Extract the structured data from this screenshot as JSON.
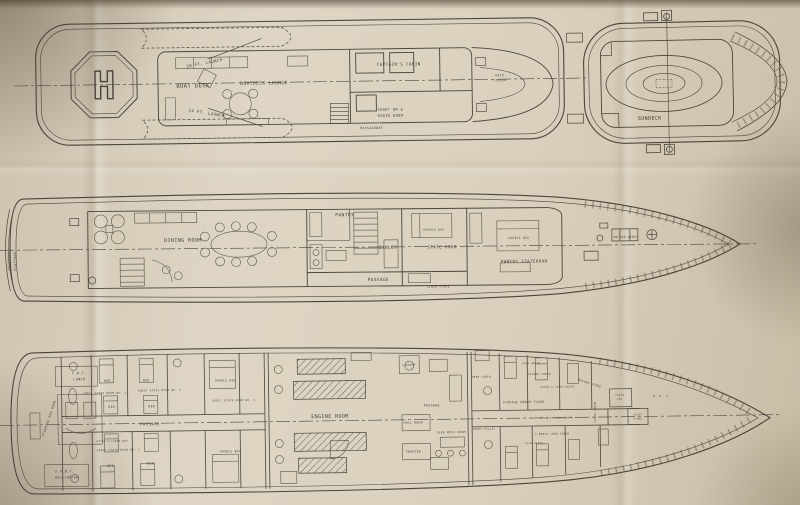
{
  "drawing": {
    "type": "yacht-general-arrangement-plan",
    "paper_color": "#dad0bd",
    "ink_color": "#4a453c"
  },
  "decks": [
    {
      "name": "BOAT DECK",
      "labels": [
        {
          "t": "20 FT. LAUNCH",
          "x": 205,
          "y": 63,
          "s": 4,
          "r": -10
        },
        {
          "t": "BOAT DECK",
          "x": 193,
          "y": 86,
          "s": 5.5,
          "sp": 2.5
        },
        {
          "t": "24 FT. LAUNCH",
          "x": 206,
          "y": 113,
          "s": 4,
          "r": 10
        },
        {
          "t": "BOATDECK LOUNGE",
          "x": 264,
          "y": 84,
          "s": 4.6,
          "sp": 0.6
        },
        {
          "t": "CAPTAIN'S CABIN",
          "x": 399,
          "y": 67,
          "s": 4.2
        },
        {
          "t": "CHART RM &",
          "x": 390,
          "y": 112,
          "s": 3.6
        },
        {
          "t": "RADIO ROOM",
          "x": 390,
          "y": 118,
          "s": 3.6
        },
        {
          "t": "PASSAGEWAY",
          "x": 371,
          "y": 130,
          "s": 3.2
        },
        {
          "t": "DECK",
          "x": 500,
          "y": 79,
          "s": 3
        },
        {
          "t": "LOCKER",
          "x": 500,
          "y": 84,
          "s": 3
        },
        {
          "t": "H",
          "x": 104,
          "y": 96,
          "s": 38,
          "cls": "heli"
        }
      ]
    },
    {
      "name": "SUNDECK",
      "labels": [
        {
          "t": "SUNDECK",
          "x": 649,
          "y": 119,
          "s": 5,
          "sp": 2
        }
      ]
    },
    {
      "name": "MAIN DECK",
      "labels": [
        {
          "t": "SWIMMING",
          "x": 10,
          "y": 258,
          "s": 3.2,
          "r": -90
        },
        {
          "t": "PLATFORM",
          "x": 16,
          "y": 258,
          "s": 3.2,
          "r": -90
        },
        {
          "t": "DINING ROOM",
          "x": 183,
          "y": 240,
          "s": 5,
          "sp": 1.2
        },
        {
          "t": "PANTRY",
          "x": 345,
          "y": 216,
          "s": 4.6,
          "sp": 0.8
        },
        {
          "t": "GALLEY",
          "x": 388,
          "y": 249,
          "s": 4.6,
          "sp": 0.8
        },
        {
          "t": "PASSAGE",
          "x": 378,
          "y": 281,
          "s": 4.4,
          "sp": 1
        },
        {
          "t": "STATE ROOM",
          "x": 442,
          "y": 249,
          "s": 4.2
        },
        {
          "t": "DOUBLE BED",
          "x": 434,
          "y": 231,
          "s": 2.8
        },
        {
          "t": "LINEN STORE",
          "x": 438,
          "y": 288,
          "s": 2.8
        },
        {
          "t": "OWNERS STATEROOM",
          "x": 524,
          "y": 264,
          "s": 4.2
        },
        {
          "t": "DOUBLE BED",
          "x": 519,
          "y": 240,
          "s": 2.8
        },
        {
          "t": "ANCHOR WINCH",
          "x": 626,
          "y": 240,
          "s": 2.8
        }
      ]
    },
    {
      "name": "LOWER DECK",
      "labels": [
        {
          "t": "F.B.T.",
          "x": 80,
          "y": 370,
          "s": 3.4
        },
        {
          "t": "LUNCH",
          "x": 80,
          "y": 376,
          "s": 3.4
        },
        {
          "t": "STEERING ENG ROOM",
          "x": 50,
          "y": 414,
          "s": 3,
          "r": -70
        },
        {
          "t": "F.P.B.T.",
          "x": 64,
          "y": 468,
          "s": 3.2
        },
        {
          "t": "HELICOPTER",
          "x": 66,
          "y": 474,
          "s": 3.2
        },
        {
          "t": "BED",
          "x": 108,
          "y": 378,
          "s": 3
        },
        {
          "t": "BED",
          "x": 147,
          "y": 378,
          "s": 3
        },
        {
          "t": "GUEST STATE ROOM NO. 1",
          "x": 105,
          "y": 390,
          "s": 2.6
        },
        {
          "t": "GUEST STATE ROOM NO. 2",
          "x": 160,
          "y": 388,
          "s": 2.6
        },
        {
          "t": "BED",
          "x": 112,
          "y": 404,
          "s": 3
        },
        {
          "t": "BED",
          "x": 152,
          "y": 404,
          "s": 3
        },
        {
          "t": "PASSAGE",
          "x": 150,
          "y": 422,
          "s": 4,
          "sp": 1
        },
        {
          "t": "UPPER & LOWER BED",
          "x": 112,
          "y": 438,
          "s": 2.4
        },
        {
          "t": "GUEST STATE ROOM NO. 3",
          "x": 118,
          "y": 447,
          "s": 2.6
        },
        {
          "t": "BED",
          "x": 110,
          "y": 463,
          "s": 3
        },
        {
          "t": "BED",
          "x": 150,
          "y": 461,
          "s": 3
        },
        {
          "t": "DOUBLE BED",
          "x": 226,
          "y": 379,
          "s": 2.8
        },
        {
          "t": "GUEST STATE ROOM NO. 4",
          "x": 234,
          "y": 399,
          "s": 2.6
        },
        {
          "t": "DOUBLE BED",
          "x": 230,
          "y": 450,
          "s": 2.8
        },
        {
          "t": "ENGINE ROOM",
          "x": 330,
          "y": 417,
          "s": 5,
          "sp": 1.5
        },
        {
          "t": "LAUNDRY",
          "x": 410,
          "y": 366,
          "s": 2.6
        },
        {
          "t": "COOL ROOM",
          "x": 413,
          "y": 424,
          "s": 3
        },
        {
          "t": "FREEZER",
          "x": 413,
          "y": 453,
          "s": 3
        },
        {
          "t": "PASSAGE",
          "x": 432,
          "y": 407,
          "s": 3.2
        },
        {
          "t": "CREW MESS ROOM",
          "x": 451,
          "y": 434,
          "s": 2.8
        },
        {
          "t": "CREWS GALLEY",
          "x": 484,
          "y": 431,
          "s": 2.5
        },
        {
          "t": "STORAGE UNDER FLOOR",
          "x": 524,
          "y": 405,
          "s": 3
        },
        {
          "t": "CREW CABIN",
          "x": 482,
          "y": 379,
          "s": 2.5
        },
        {
          "t": "OILERS CABIN",
          "x": 540,
          "y": 377,
          "s": 2.5
        },
        {
          "t": "UPPER & LOWER BERTH",
          "x": 558,
          "y": 390,
          "s": 2.3
        },
        {
          "t": "UPPER & LOWER BERTH",
          "x": 556,
          "y": 421,
          "s": 2.3
        },
        {
          "t": "2 BERTH CREW CABIN",
          "x": 552,
          "y": 437,
          "s": 2.5
        },
        {
          "t": "HIGH BERTH",
          "x": 532,
          "y": 366,
          "s": 2.3
        },
        {
          "t": "HIGH BERTH",
          "x": 534,
          "y": 446,
          "s": 2.3
        },
        {
          "t": "BOSUNS STORE",
          "x": 590,
          "y": 387,
          "s": 2.7,
          "r": 18
        },
        {
          "t": "CREWS CABIN",
          "x": 596,
          "y": 415,
          "s": 2.5,
          "r": -90
        },
        {
          "t": "CHAIN",
          "x": 620,
          "y": 399,
          "s": 2.3
        },
        {
          "t": "LKR",
          "x": 620,
          "y": 403,
          "s": 2.3
        },
        {
          "t": "PAINT",
          "x": 638,
          "y": 419,
          "s": 2.3
        },
        {
          "t": "STORE",
          "x": 638,
          "y": 423,
          "s": 2.3
        },
        {
          "t": "F. P. T.",
          "x": 662,
          "y": 401,
          "s": 3
        }
      ]
    }
  ]
}
